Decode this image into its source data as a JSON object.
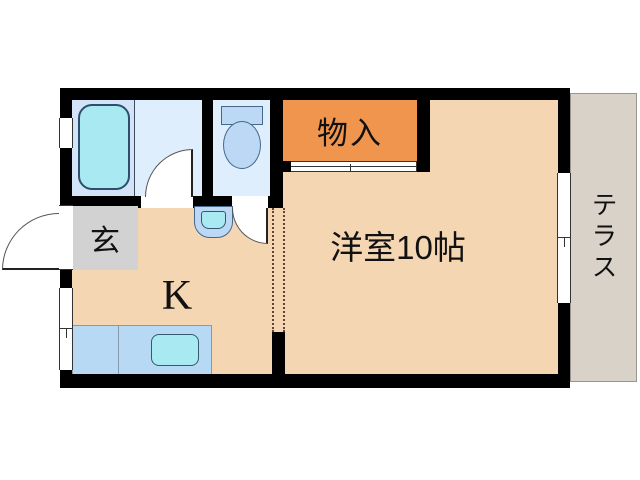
{
  "plan_type": "apartment-floor-plan",
  "rooms": {
    "main_room": {
      "label": "洋室10帖"
    },
    "kitchen": {
      "label": "K"
    },
    "closet": {
      "label": "物入"
    },
    "entrance": {
      "label": "玄"
    },
    "terrace": {
      "label": "テラス"
    }
  },
  "fixtures": {
    "bathtub": "bathtub",
    "toilet": "toilet",
    "wash_basin": "wash-basin",
    "kitchen_sink": "kitchen-sink"
  },
  "colors": {
    "wall": "#000000",
    "floor": "#f5d6b2",
    "closet": "#f0954e",
    "bath_floor": "#dfeefc",
    "bath_floor_dark": "#d3e4f8",
    "water": "#a9e9f2",
    "fixture": "#bcd8f4",
    "counter": "#b7d9f3",
    "entrance_floor": "#d2d2d2",
    "terrace": "#d9d2c9",
    "outline": "#2e4e6e"
  }
}
